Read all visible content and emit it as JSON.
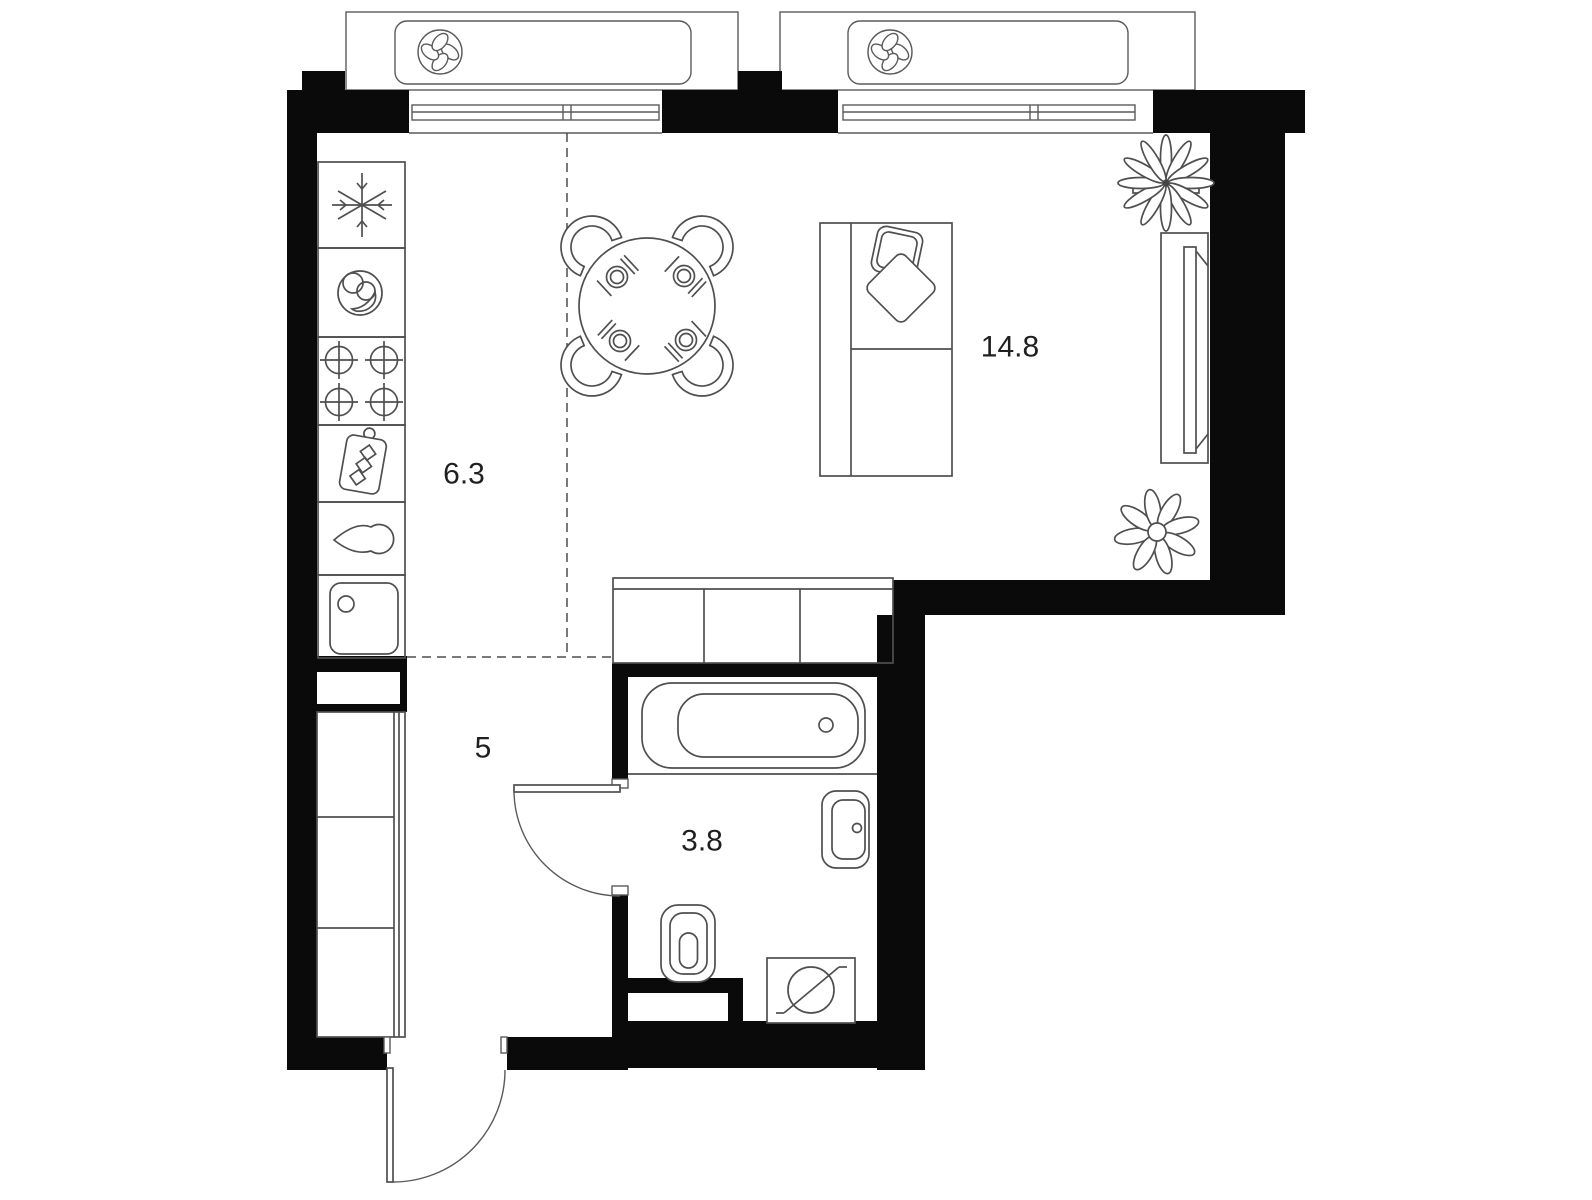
{
  "plan": {
    "type": "apartment-floor-plan",
    "rooms": {
      "living_room": {
        "area_label": "14.8"
      },
      "kitchen": {
        "area_label": "6.3"
      },
      "hallway": {
        "area_label": "5"
      },
      "bathroom": {
        "area_label": "3.8"
      }
    },
    "colors": {
      "wall": "#0a0a0a",
      "furniture_line": "#4f4f4f",
      "background": "#ffffff",
      "label_text": "#1f1f1f"
    },
    "fixtures": [
      "ventilation-fan-icon",
      "snowflake-freezer-icon",
      "plate-icon",
      "stove-burners-icon",
      "cutting-board-icon",
      "water-drop-icon",
      "kitchen-sink-icon",
      "dining-table-icon",
      "chair-icon",
      "sofa-icon",
      "pillow-icon",
      "tv-stand-icon",
      "flower-plant-icon",
      "leaf-plant-icon",
      "wardrobe-icon",
      "bathtub-icon",
      "washbasin-icon",
      "toilet-icon",
      "washing-machine-icon",
      "door-swing-icon"
    ]
  }
}
